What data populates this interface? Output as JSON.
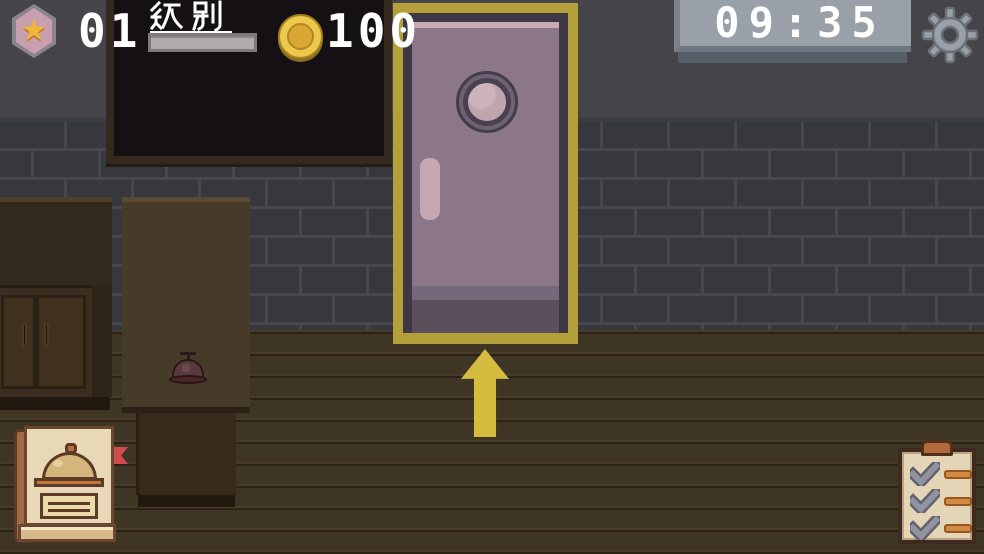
{
  "hud": {
    "level": {
      "badge_icon": "star-badge-icon",
      "value": "01",
      "label": "级别",
      "xp_bar": {
        "fill_color": "#b0abaf",
        "appearance": "full"
      }
    },
    "coins": {
      "icon": "coin-icon",
      "value": "100"
    },
    "timer": {
      "value": "09:35"
    },
    "settings": {
      "icon": "gear-icon"
    }
  },
  "scene": {
    "door": {
      "name": "entrance-door",
      "highlighted": true,
      "highlight_color": "#b3a039",
      "hint_icon": "up-arrow"
    },
    "blackboard": {
      "name": "blackboard"
    },
    "cabinet": {
      "name": "cabinet"
    },
    "counter": {
      "name": "service-counter"
    },
    "bell": {
      "name": "service-bell"
    },
    "menu_book": {
      "name": "menu-book-button",
      "bookmark_color": "#d04a4f"
    },
    "task_board": {
      "name": "task-clipboard-button",
      "checked_items": 3
    }
  },
  "colors": {
    "wall_upper": "#444449",
    "brick": "#36383d",
    "mortar": "#47484d",
    "floor": "#3e3525",
    "accent_yellow": "#d4bc3e",
    "door_panel": "#8b7787",
    "timer_panel": "#9aa0a8",
    "text": "#ffffff"
  }
}
